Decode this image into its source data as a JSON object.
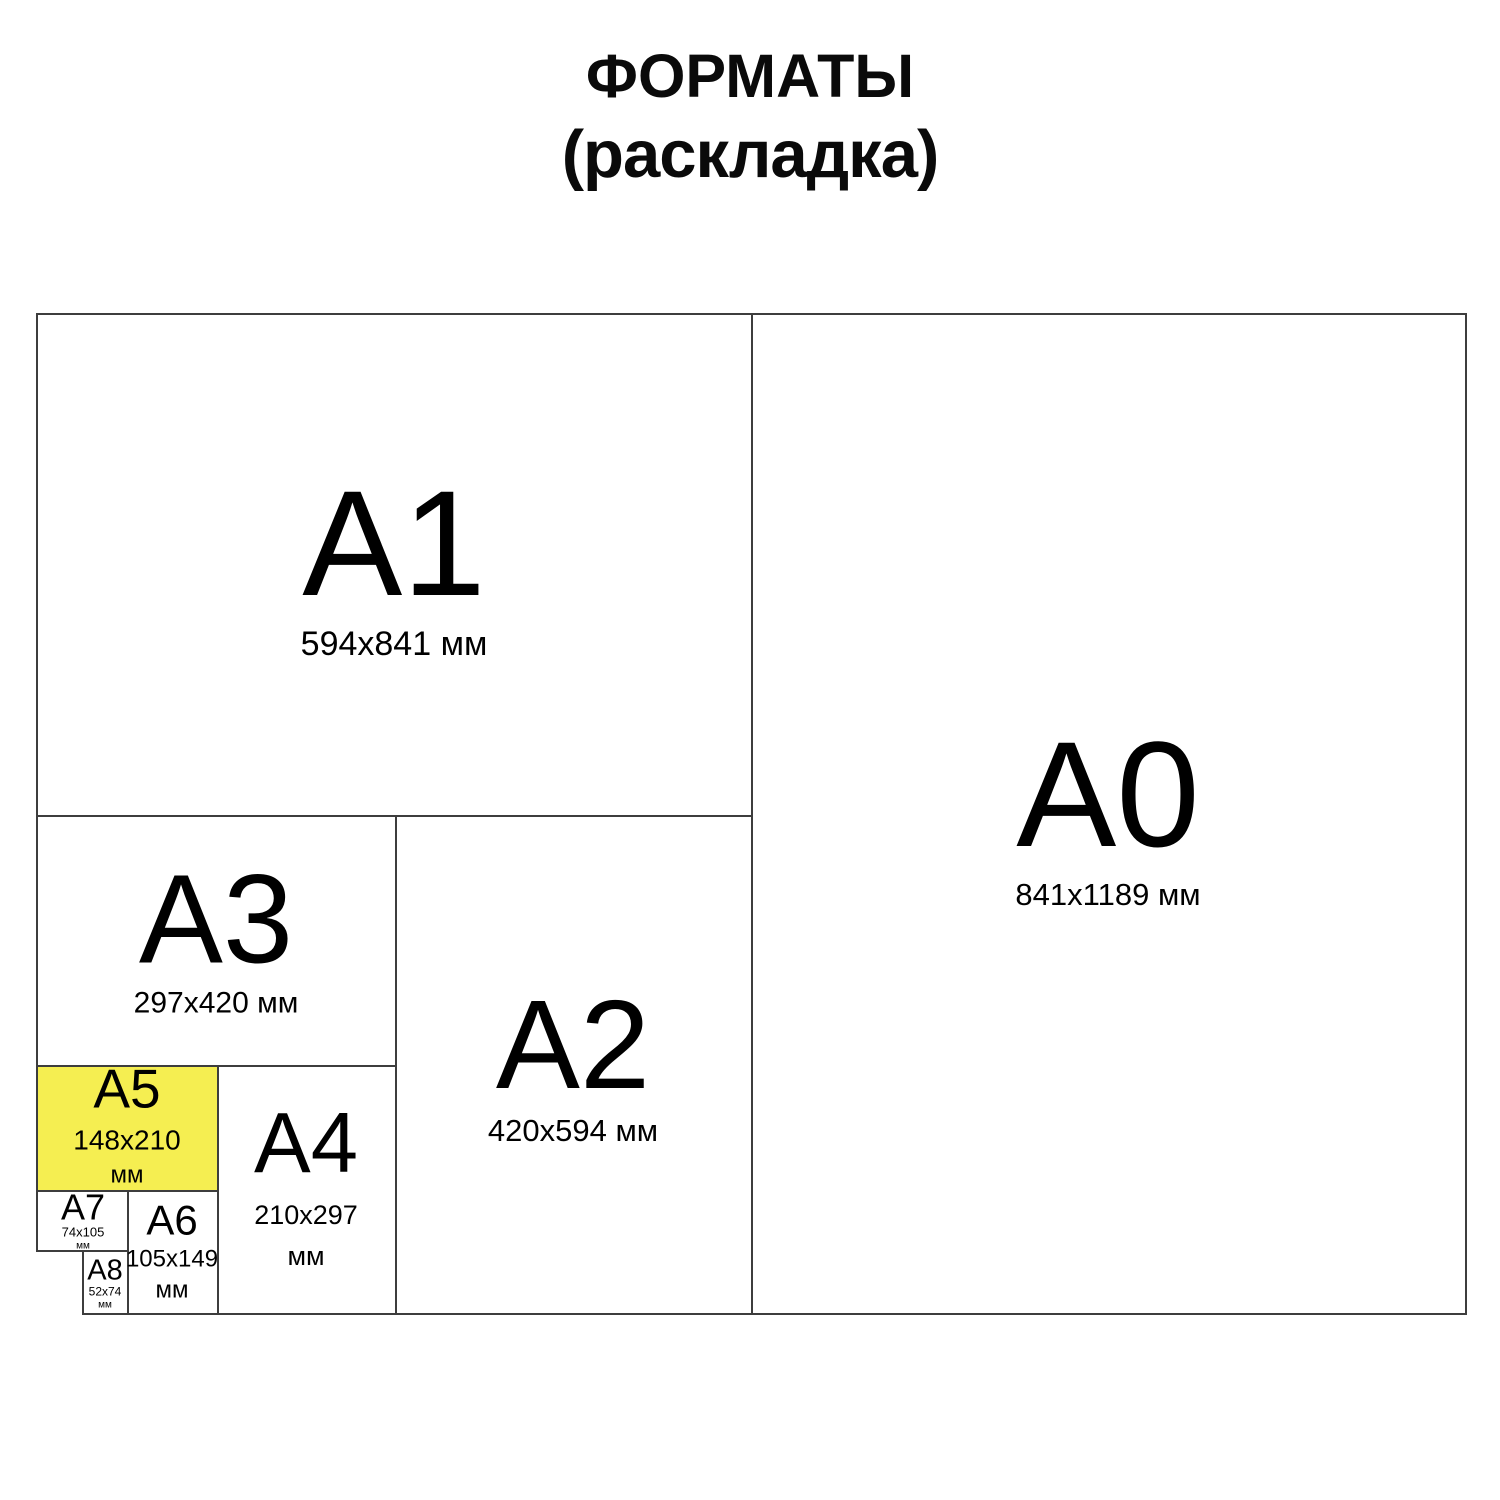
{
  "title": {
    "line1": "ФОРМАТЫ",
    "line2": "(раскладка)"
  },
  "formats": {
    "a0": {
      "label": "A0",
      "size": "841x1189",
      "unit": "мм"
    },
    "a1": {
      "label": "A1",
      "size": "594x841",
      "unit": "мм"
    },
    "a2": {
      "label": "A2",
      "size": "420x594",
      "unit": "мм"
    },
    "a3": {
      "label": "A3",
      "size": "297x420",
      "unit": "мм"
    },
    "a4": {
      "label": "A4",
      "size": "210x297",
      "unit": "мм"
    },
    "a5": {
      "label": "A5",
      "size": "148x210",
      "unit": "мм",
      "highlighted": true
    },
    "a6": {
      "label": "A6",
      "size": "105x149",
      "unit": "мм"
    },
    "a7": {
      "label": "A7",
      "size": "74x105",
      "unit": "мм"
    },
    "a8": {
      "label": "A8",
      "size": "52x74",
      "unit": "мм"
    }
  },
  "colors": {
    "highlight": "#F5EE51",
    "line": "#3d3d3d",
    "text": "#000000",
    "background": "#ffffff"
  }
}
